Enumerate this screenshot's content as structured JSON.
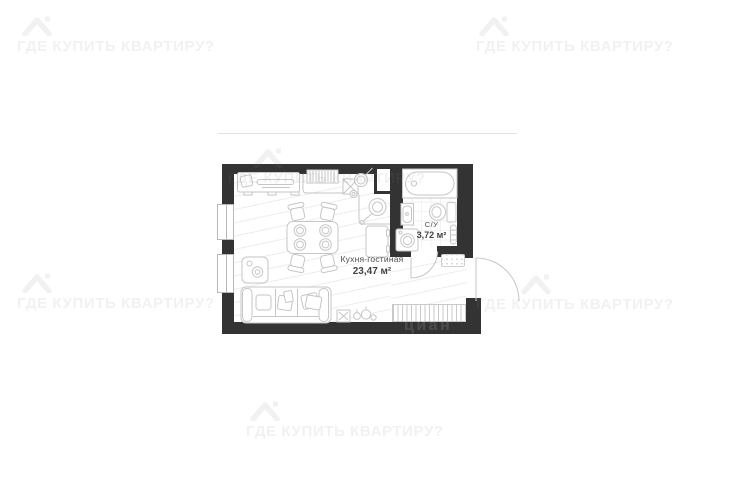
{
  "canvas": {
    "width": 735,
    "height": 480,
    "background_color": "#ffffff"
  },
  "watermark": {
    "text": "ГДЕ КУПИТЬ КВАРТИРУ?",
    "icon": "house-roof-icon",
    "color": "#f2f2f2",
    "instances": 6
  },
  "brand_watermark": {
    "text": "циан"
  },
  "floor_plan": {
    "wall_color": "#333333",
    "furniture_line_color": "#c6c6c6",
    "rooms": [
      {
        "label": "Кухня-гостиная",
        "area": "23,47 м²"
      },
      {
        "label": "С/У",
        "area": "3,72 м²"
      }
    ]
  }
}
